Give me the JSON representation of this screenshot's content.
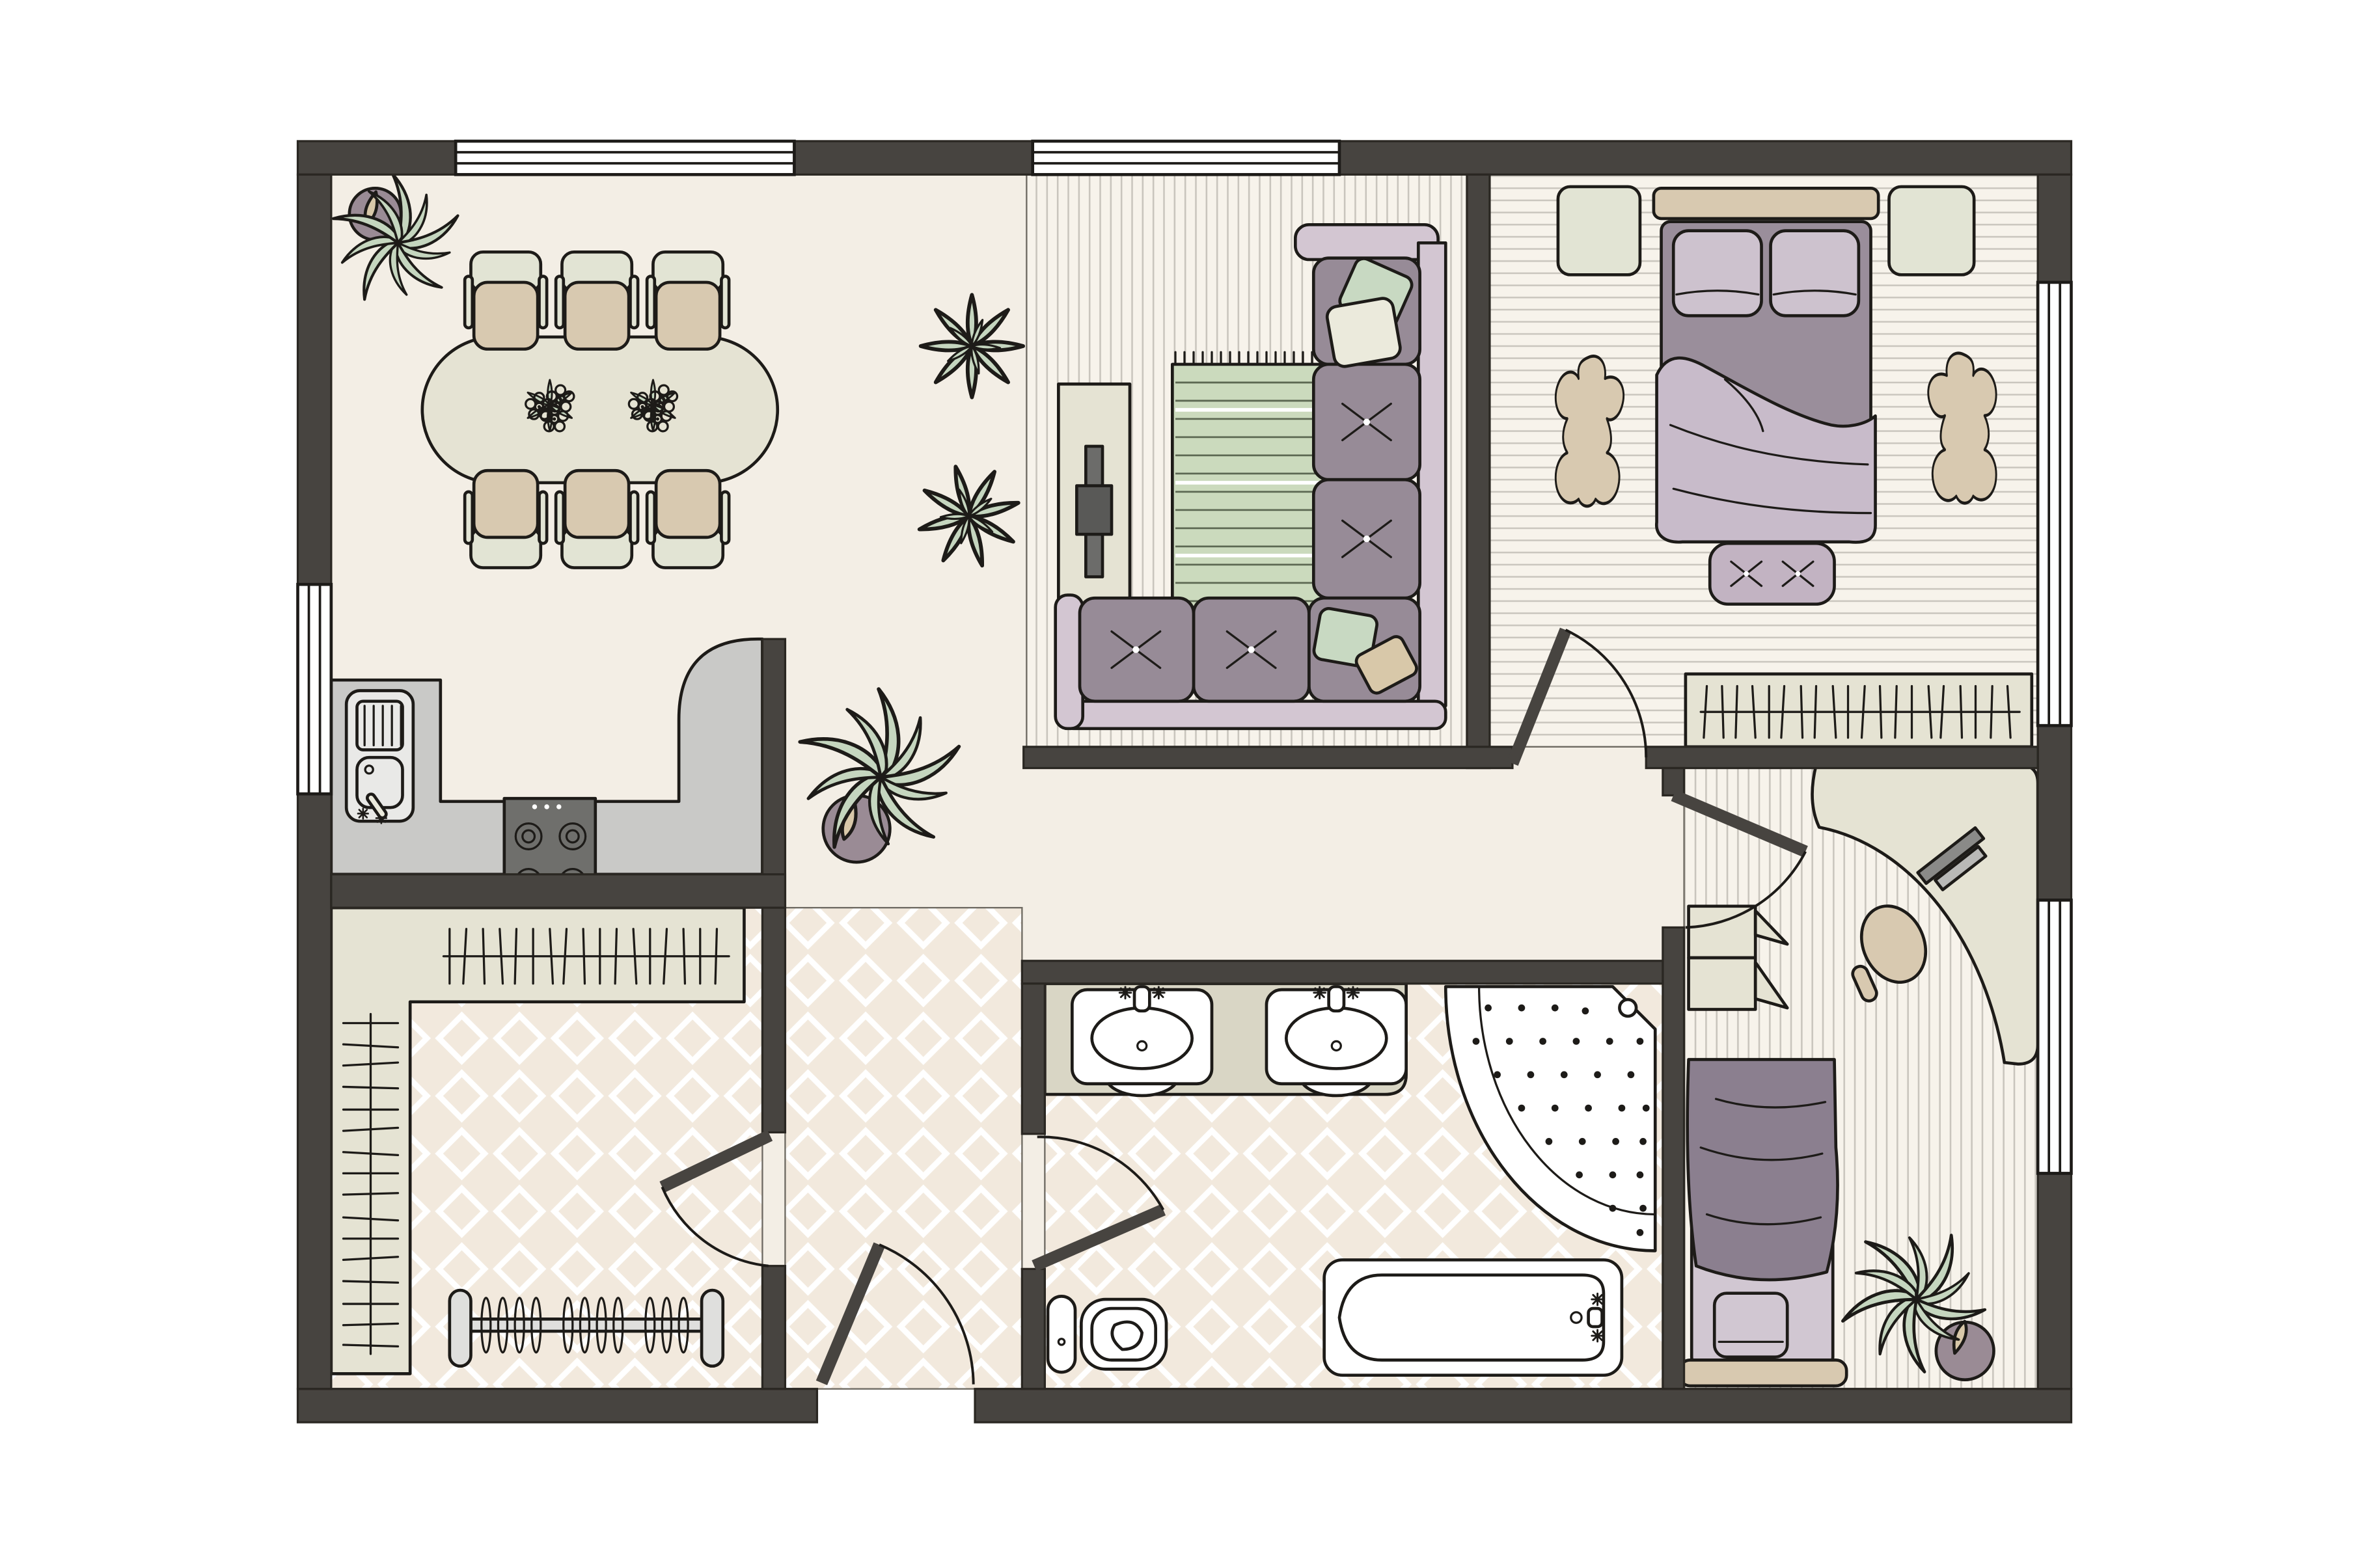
{
  "page": {
    "background": "#ffffff"
  },
  "colors": {
    "page": "#ffffff",
    "wall": "#474440",
    "wallstroke": "#2a2722",
    "outline": "#1d1b18",
    "floor": "#f3eee5",
    "stripebg": "#f7f3eb",
    "stripeline": "#c9c5bd",
    "diabg": "#f2e9dd",
    "dialine": "#ffffff",
    "counter": "#c9c9c7",
    "counterlight": "#e9e9e7",
    "stove": "#6f6f6c",
    "beige": "#e5e3d3",
    "vanity": "#d9d6c5",
    "tan": "#d8c9b0",
    "chairback": "#e2e4d4",
    "sofaframe": "#d3c6d2",
    "cushion": "#978b97",
    "pillowgreen": "#c8d9c2",
    "pillowcream": "#ebeadc",
    "pillowtan": "#d8c8a9",
    "bench": "#c2b3c2",
    "mattress": "#9a8e9b",
    "blanket": "#c8bbca",
    "bedpillow": "#cdc2ce",
    "officeblanket": "#8b7f8f",
    "officemattress": "#d1c7d2",
    "rug": "#cbdabd",
    "rugline": "#5c6852",
    "flower": "#ccb9ce",
    "plant": "#c5d6bf",
    "pot": "#9a8b95",
    "white": "#ffffff"
  },
  "plan": {
    "type": "apartment-floor-plan-top-view",
    "rooms": [
      {
        "id": "dining-area",
        "floor": "plain-cream",
        "furniture": [
          "corner-potted-plant",
          "oval-dining-table",
          "dining-chairs-x6",
          "flower-centerpieces-x2"
        ]
      },
      {
        "id": "kitchen",
        "floor": "plain-cream",
        "furniture": [
          "l-shaped-counter-with-curved-peninsula",
          "sink-unit-with-drainboard",
          "cooktop-4-burners"
        ]
      },
      {
        "id": "living-room",
        "floor": "vertical-plank-stripes",
        "furniture": [
          "media-console",
          "tv",
          "striped-fringe-rug",
          "l-shaped-sectional-sofa",
          "throw-pillows",
          "rosette-plants-x2"
        ]
      },
      {
        "id": "bedroom",
        "floor": "horizontal-plank-stripes",
        "furniture": [
          "double-bed",
          "pillows-x2",
          "blanket",
          "headboard",
          "nightstands-x2",
          "hide-rugs-x2",
          "foot-bench",
          "wardrobe-with-hanging-clothes"
        ]
      },
      {
        "id": "walk-in-closet",
        "floor": "diamond-tile",
        "furniture": [
          "l-shaped-hanging-shelf",
          "freestanding-clothes-rack"
        ]
      },
      {
        "id": "bathroom",
        "floor": "diamond-tile",
        "furniture": [
          "double-sink-vanity",
          "corner-shower",
          "bathtub",
          "toilet"
        ]
      },
      {
        "id": "home-office",
        "floor": "vertical-plank-stripes",
        "furniture": [
          "corner-desk",
          "laptop",
          "desk-chair",
          "storage-cabinet-open-doors",
          "single-bed",
          "potted-plant"
        ]
      },
      {
        "id": "hallway",
        "floor": "plain-cream-and-diamond-tile",
        "furniture": [
          "potted-plant"
        ]
      }
    ],
    "doors": [
      "entrance-door",
      "bedroom-door",
      "office-door",
      "bathroom-door",
      "closet-door"
    ],
    "windows": [
      "dining-top-window",
      "living-top-window",
      "dining-left-window",
      "bedroom-right-window",
      "office-right-window"
    ]
  }
}
